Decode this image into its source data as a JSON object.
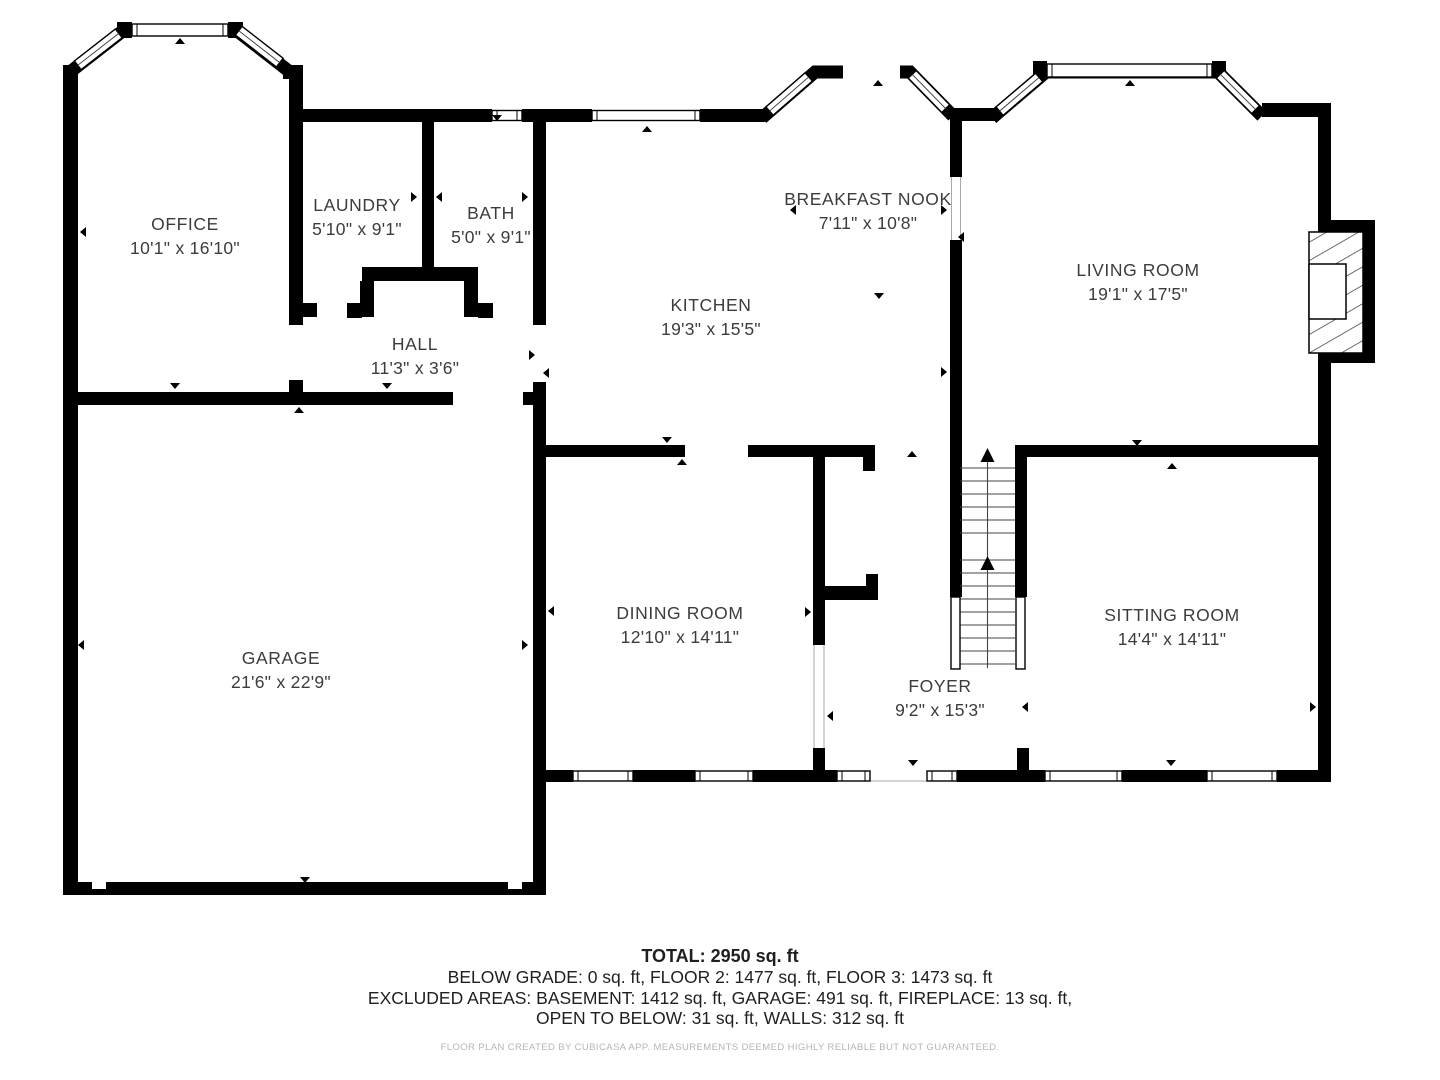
{
  "floor_plan": {
    "rooms": [
      {
        "id": "office",
        "name": "OFFICE",
        "dims": "10'1\" x 16'10\""
      },
      {
        "id": "laundry",
        "name": "LAUNDRY",
        "dims": "5'10\" x 9'1\""
      },
      {
        "id": "bath",
        "name": "BATH",
        "dims": "5'0\" x 9'1\""
      },
      {
        "id": "hall",
        "name": "HALL",
        "dims": "11'3\" x 3'6\""
      },
      {
        "id": "kitchen",
        "name": "KITCHEN",
        "dims": "19'3\" x 15'5\""
      },
      {
        "id": "breakfast-nook",
        "name": "BREAKFAST NOOK",
        "dims": "7'11\" x 10'8\""
      },
      {
        "id": "living-room",
        "name": "LIVING ROOM",
        "dims": "19'1\" x 17'5\""
      },
      {
        "id": "garage",
        "name": "GARAGE",
        "dims": "21'6\" x 22'9\""
      },
      {
        "id": "dining-room",
        "name": "DINING ROOM",
        "dims": "12'10\" x 14'11\""
      },
      {
        "id": "foyer",
        "name": "FOYER",
        "dims": "9'2\" x 15'3\""
      },
      {
        "id": "sitting-room",
        "name": "SITTING ROOM",
        "dims": "14'4\" x 14'11\""
      }
    ],
    "summary": {
      "total": "TOTAL: 2950 sq. ft",
      "line2": "BELOW GRADE: 0 sq. ft, FLOOR 2: 1477 sq. ft, FLOOR 3: 1473 sq. ft",
      "line3": "EXCLUDED AREAS: BASEMENT: 1412 sq. ft, GARAGE: 491 sq. ft, FIREPLACE: 13 sq. ft,",
      "line4": "OPEN TO BELOW: 31 sq. ft, WALLS: 312 sq. ft"
    },
    "disclaimer": "FLOOR PLAN CREATED BY CUBICASA APP. MEASUREMENTS DEEMED HIGHLY RELIABLE BUT NOT GUARANTEED.",
    "colors": {
      "wall": "#000000",
      "room_text": "#3c3c3c",
      "footer_text": "#1f1f1f",
      "disclaimer_text": "#b5b5b5",
      "background": "#ffffff"
    }
  }
}
